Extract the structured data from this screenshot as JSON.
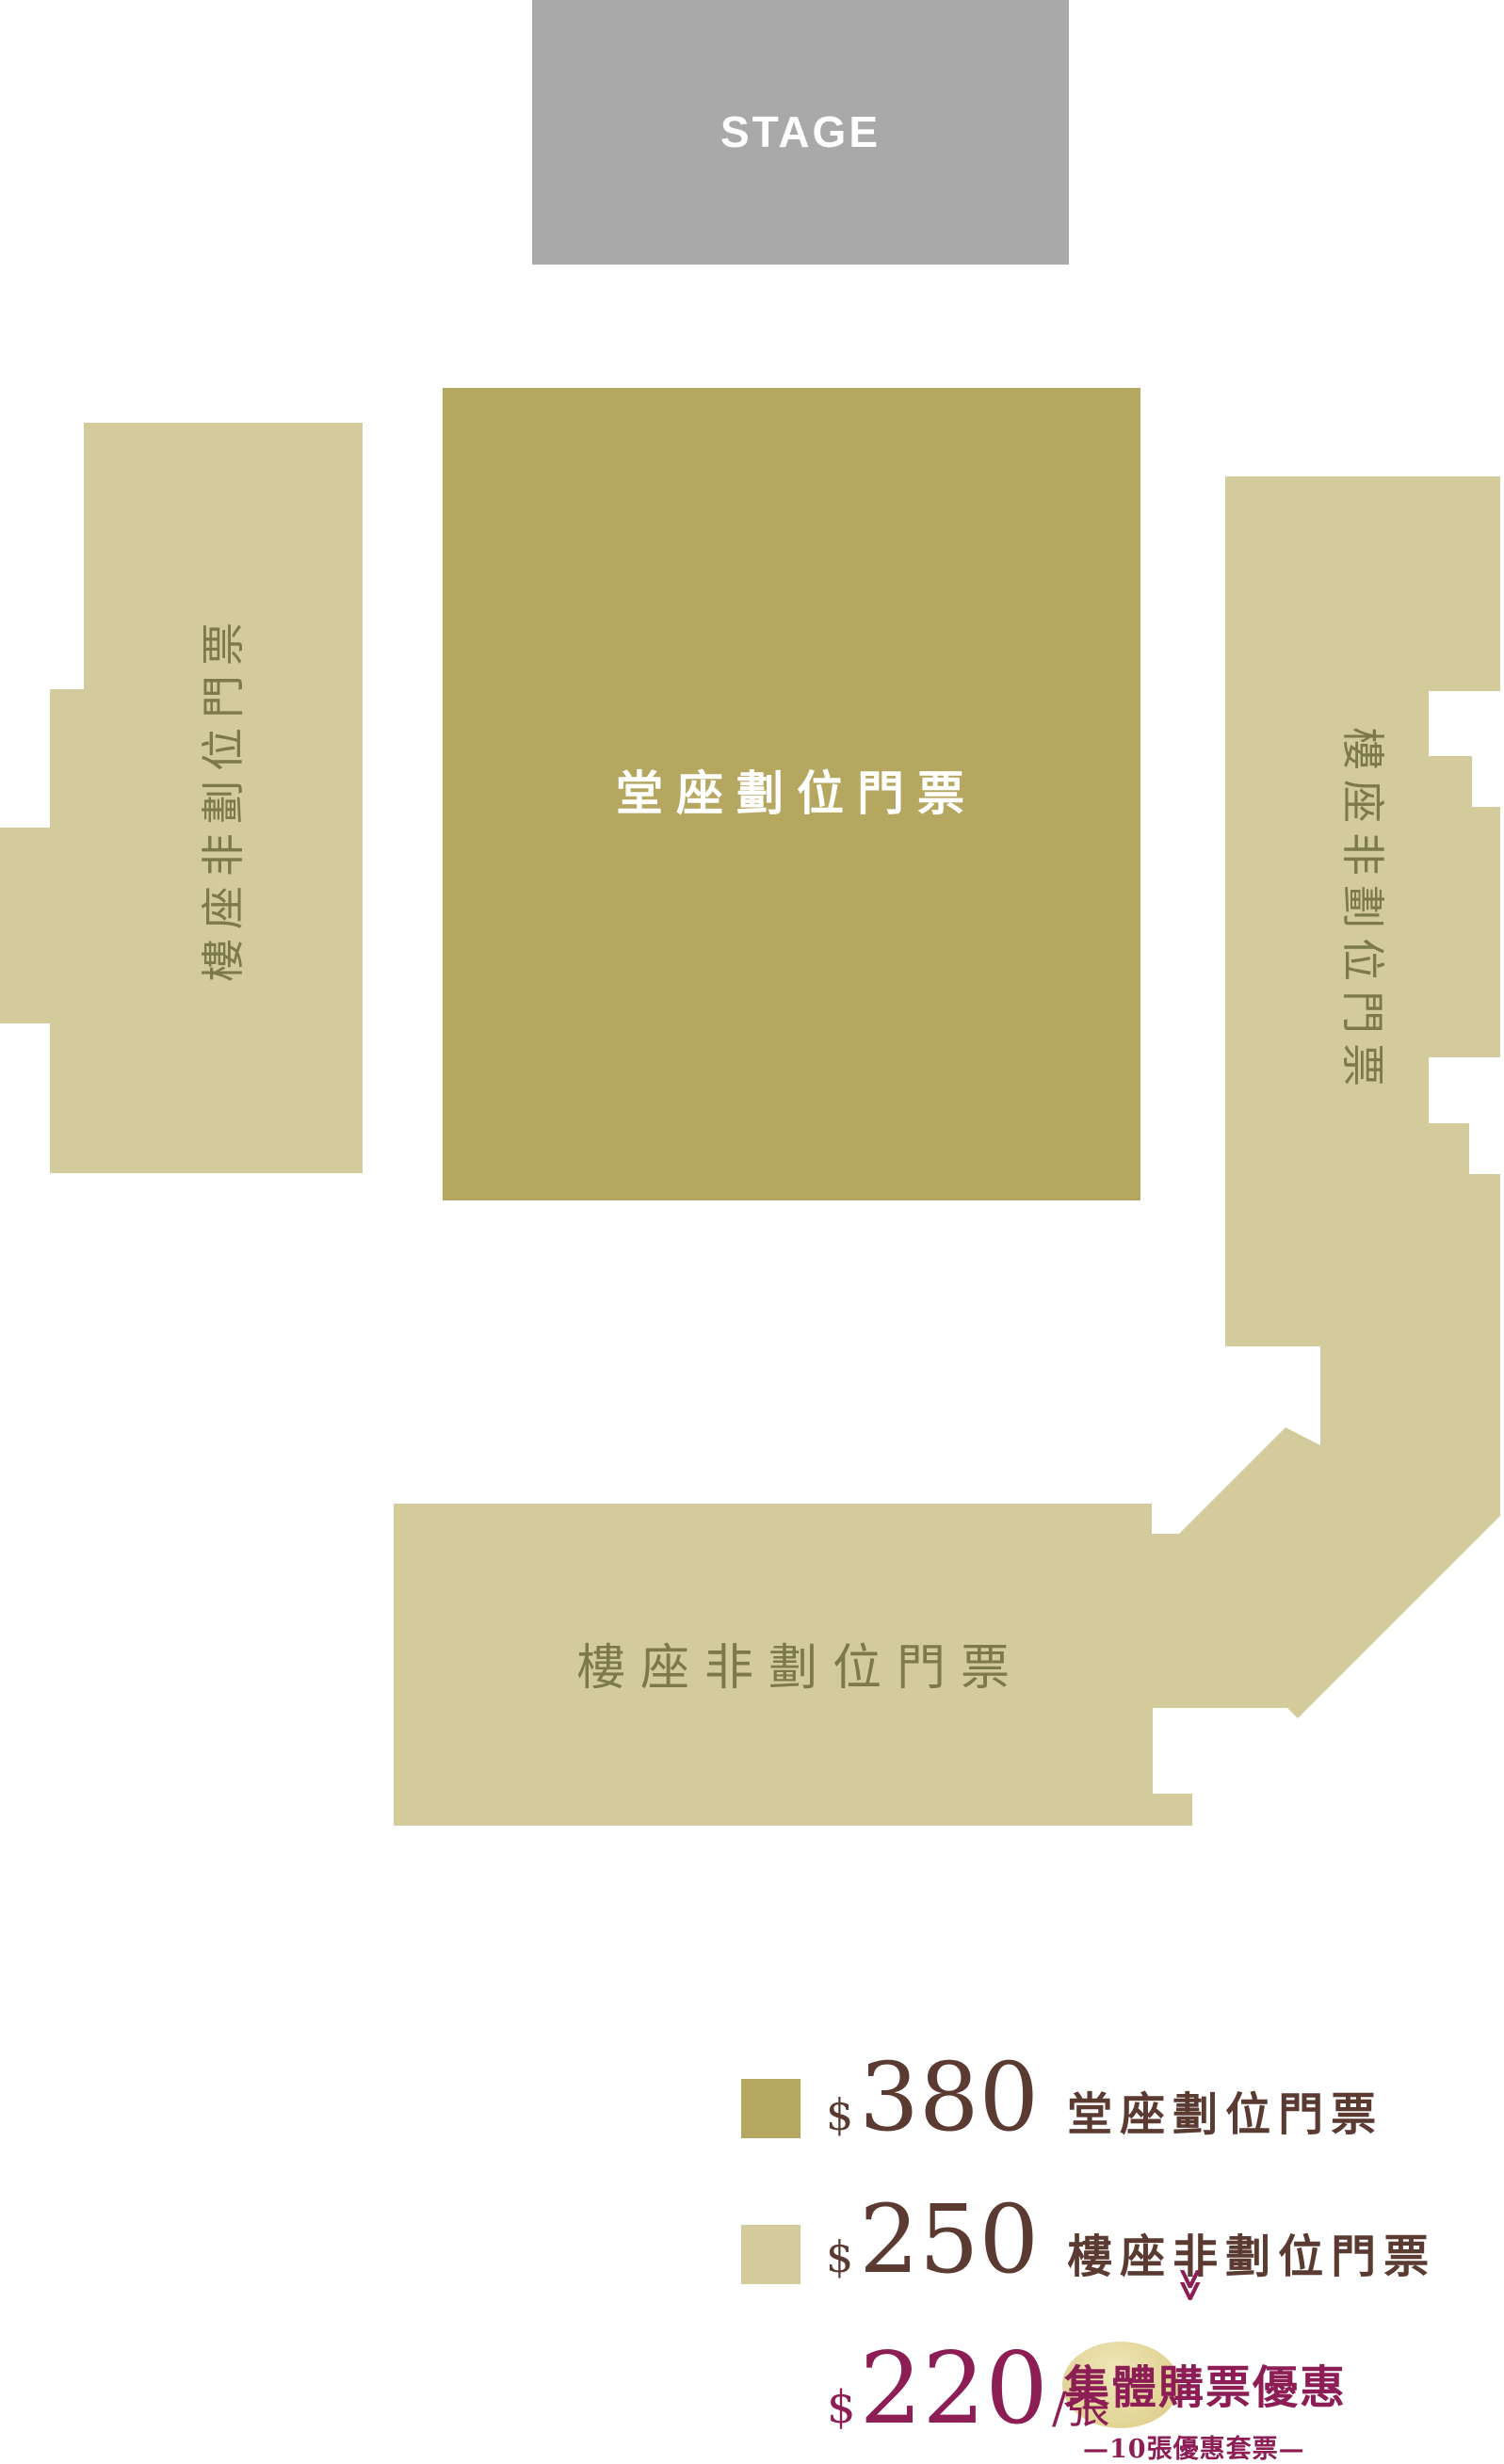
{
  "stage": {
    "label": "STAGE",
    "color": "#a9a9a9",
    "text_color": "#ffffff"
  },
  "zones": {
    "stalls": {
      "label": "堂座劃位門票",
      "color": "#b5a660",
      "text_color": "#ffffff"
    },
    "balcony_left": {
      "label": "樓座非劃位門票"
    },
    "balcony_right": {
      "label": "樓座非劃位門票"
    },
    "balcony_rear": {
      "label": "樓座非劃位門票"
    },
    "balcony_color": "#d4cb9d",
    "balcony_text_color": "#7c7a49"
  },
  "legend": {
    "price_color": "#5b3a31",
    "items": [
      {
        "currency": "$",
        "price": "380",
        "label": "堂座劃位門票",
        "swatch_color": "#b5a660"
      },
      {
        "currency": "$",
        "price": "250",
        "label": "樓座非劃位門票",
        "swatch_color": "#d4cb9d"
      }
    ],
    "group_offer": {
      "currency": "$",
      "price": "220",
      "unit": "/張",
      "chevron": "≫",
      "title": "集體購票優惠",
      "subtitle": "—10張優惠套票—",
      "accent_color": "#8c1e55"
    }
  }
}
